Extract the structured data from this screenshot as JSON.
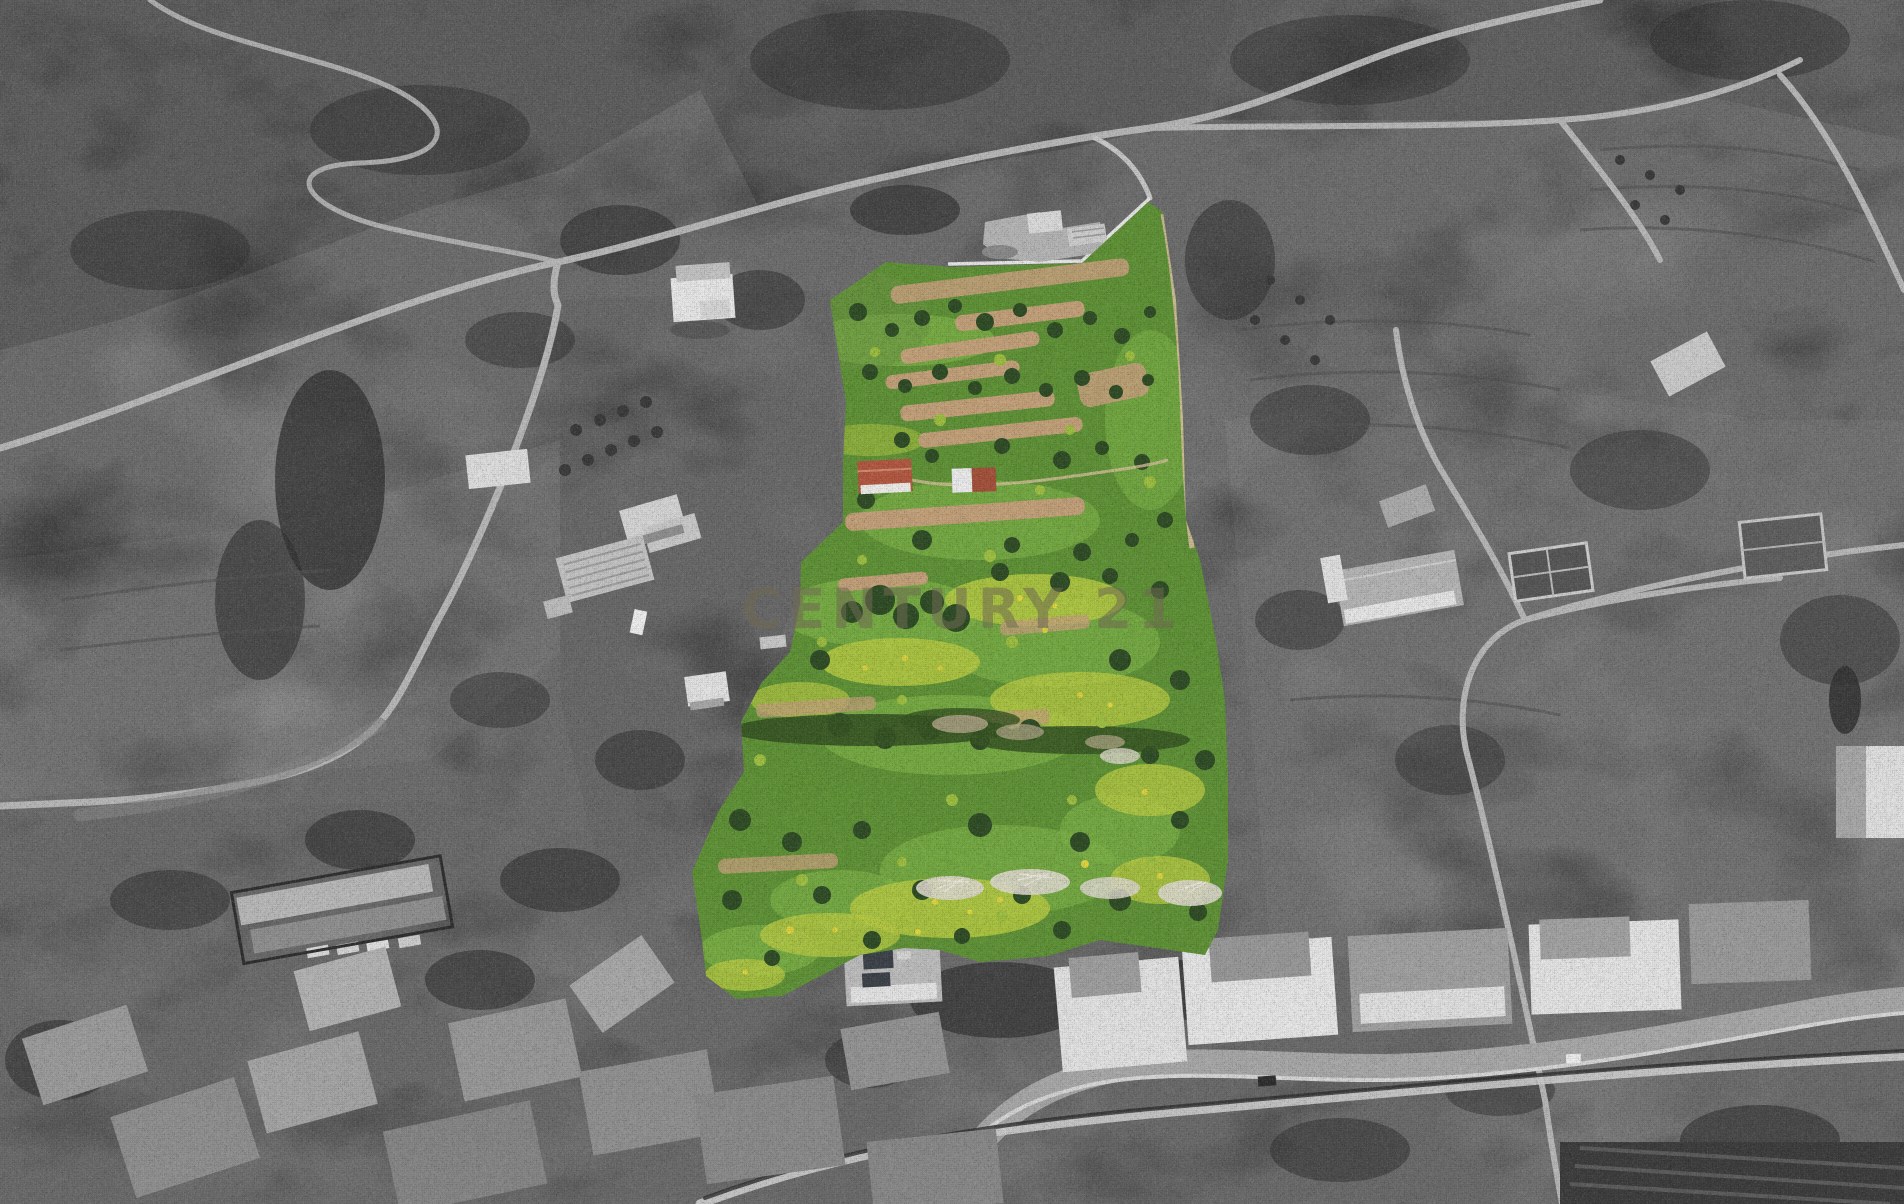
{
  "image": {
    "kind": "aerial-drone-photograph-of-rural-property",
    "style": "grayscale background with color-highlighted land parcel"
  },
  "watermark": {
    "text": "CENTURY 21",
    "color": "#6f6a52",
    "opacity": "0.55"
  },
  "colors": {
    "base_gray": "#5c5c5c",
    "hill_dark": "#3d3d3d",
    "hill_mid": "#4a4a4a",
    "field_gray": "#6f6f6f",
    "valley_gray": "#585858",
    "village_gray": "#7b7b7b",
    "road_gray": "#b8b8b8",
    "wall_white": "#e8e8e8",
    "house_white": "#e9e9e9",
    "roof_gray": "#9a9a9a",
    "vegetation_dark": "#2f2f2f",
    "parcel_green": "#5d9133",
    "parcel_green_light": "#7cb244",
    "parcel_green_dull": "#6a9440",
    "flower_green": "#b6cb40",
    "flower_yellow": "#e0d53c",
    "tree_green": "#2c4a22",
    "bush_green": "#9dbf3e",
    "terrace_tan": "#c3a078",
    "track_tan": "#d6c09a",
    "roof_red": "#b3563e",
    "dead_tree_white": "#ded9cc"
  }
}
